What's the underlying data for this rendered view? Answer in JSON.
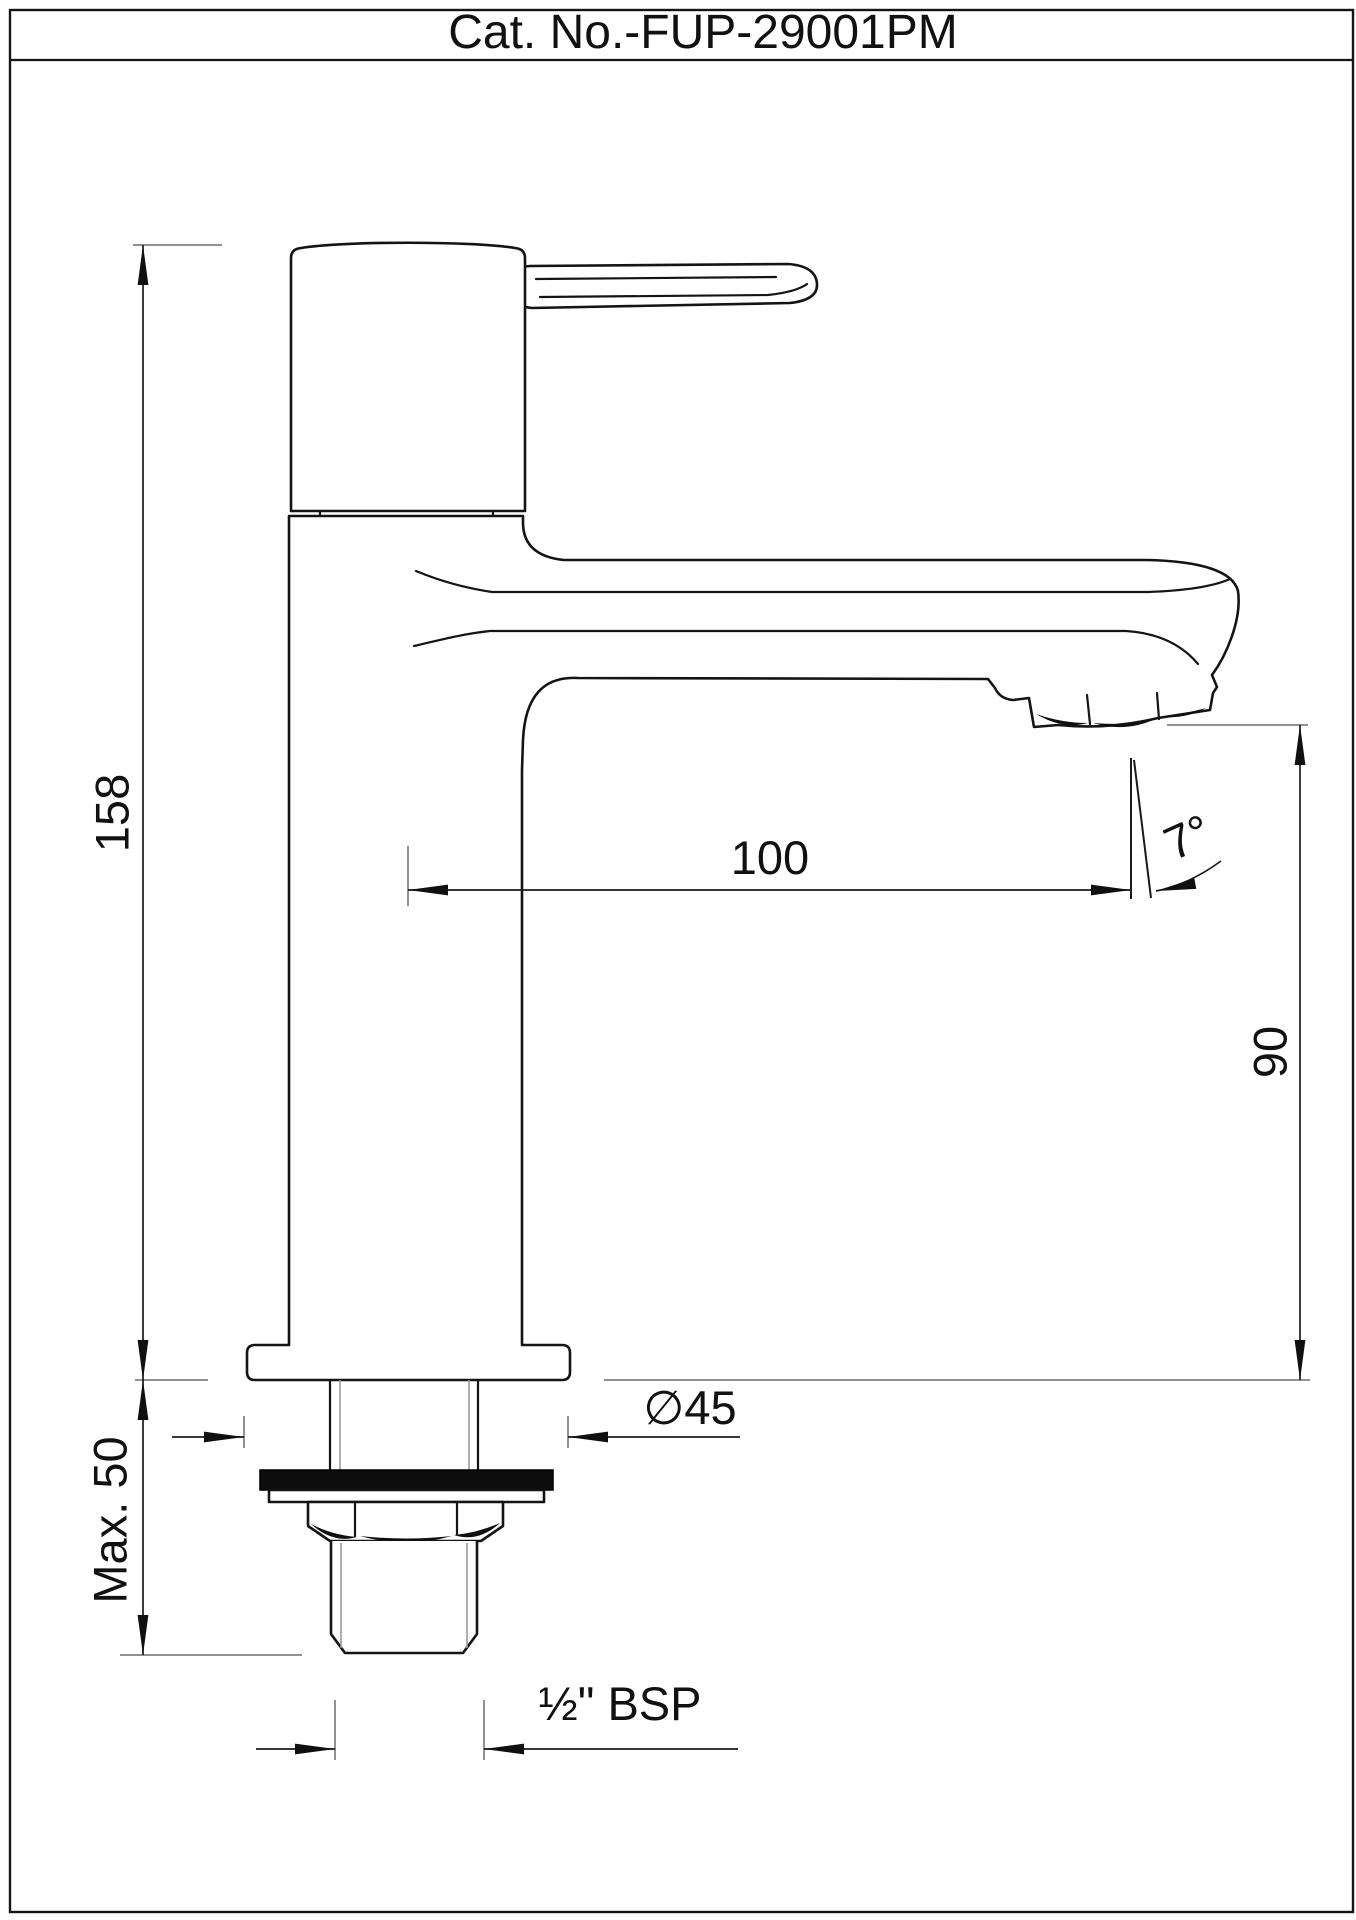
{
  "page": {
    "title": "Cat. No.-FUP-29001PM"
  },
  "drawing": {
    "subject": "Single-lever tall pillar faucet, dimensioned side elevation",
    "units": "mm",
    "dimensions": {
      "overall_height": "158",
      "spout_reach": "100",
      "spout_angle": "7°",
      "outlet_height": "90",
      "flange_diameter": "∅45",
      "max_mounting_thickness": "Max. 50",
      "inlet_thread": "½\" BSP"
    }
  }
}
